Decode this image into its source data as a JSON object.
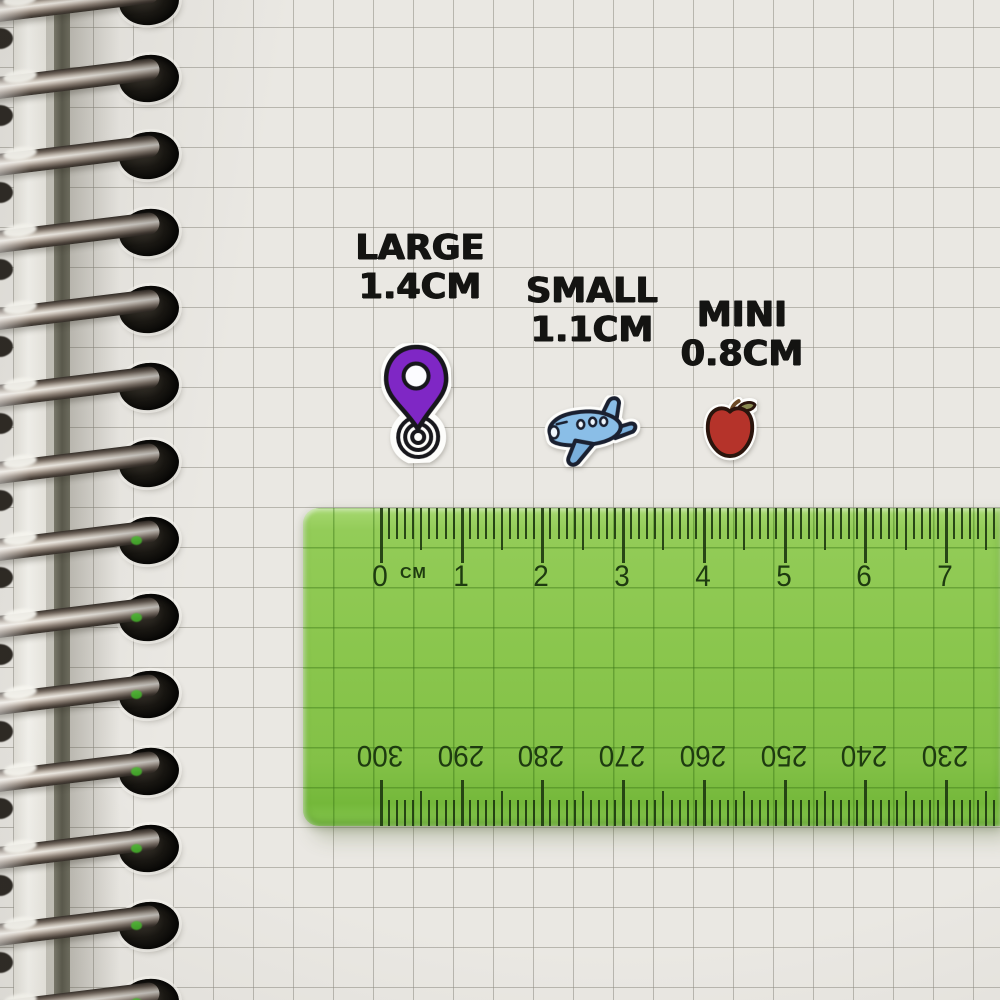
{
  "size_labels": {
    "large": {
      "name": "LARGE",
      "size": "1.4CM"
    },
    "small": {
      "name": "SMALL",
      "size": "1.1CM"
    },
    "mini": {
      "name": "MINI",
      "size": "0.8CM"
    }
  },
  "stickers": {
    "pin": {
      "kind": "location-pin",
      "pin_color": "#7f27c5",
      "dot_color": "#fcfcff",
      "outline_color": "#17171c",
      "diecut_color": "#fdfdfb"
    },
    "plane": {
      "kind": "airplane",
      "body_color": "#8abee7",
      "shade_color": "#79afdc",
      "window_color": "#eef6fd",
      "outline_color": "#1a2030",
      "diecut_color": "#fdfdfb"
    },
    "apple": {
      "kind": "apple",
      "body_color": "#b5332a",
      "leaf_color": "#8a8a52",
      "stem_color": "#6d4a26",
      "outline_color": "#2a150d",
      "diecut_color": "#fdfdfb"
    }
  },
  "ruler": {
    "unit_label": "CM",
    "top_numbers": [
      "0",
      "1",
      "2",
      "3",
      "4",
      "5",
      "6",
      "7"
    ],
    "bottom_numbers": [
      "300",
      "290",
      "280",
      "270",
      "260",
      "250",
      "240",
      "230"
    ],
    "body_color": "#86c348",
    "tick_color": "#1e3b10"
  },
  "notebook": {
    "ring_count": 14,
    "paper_color": "#eae8e3",
    "grid_color": "#b3b1aa"
  }
}
